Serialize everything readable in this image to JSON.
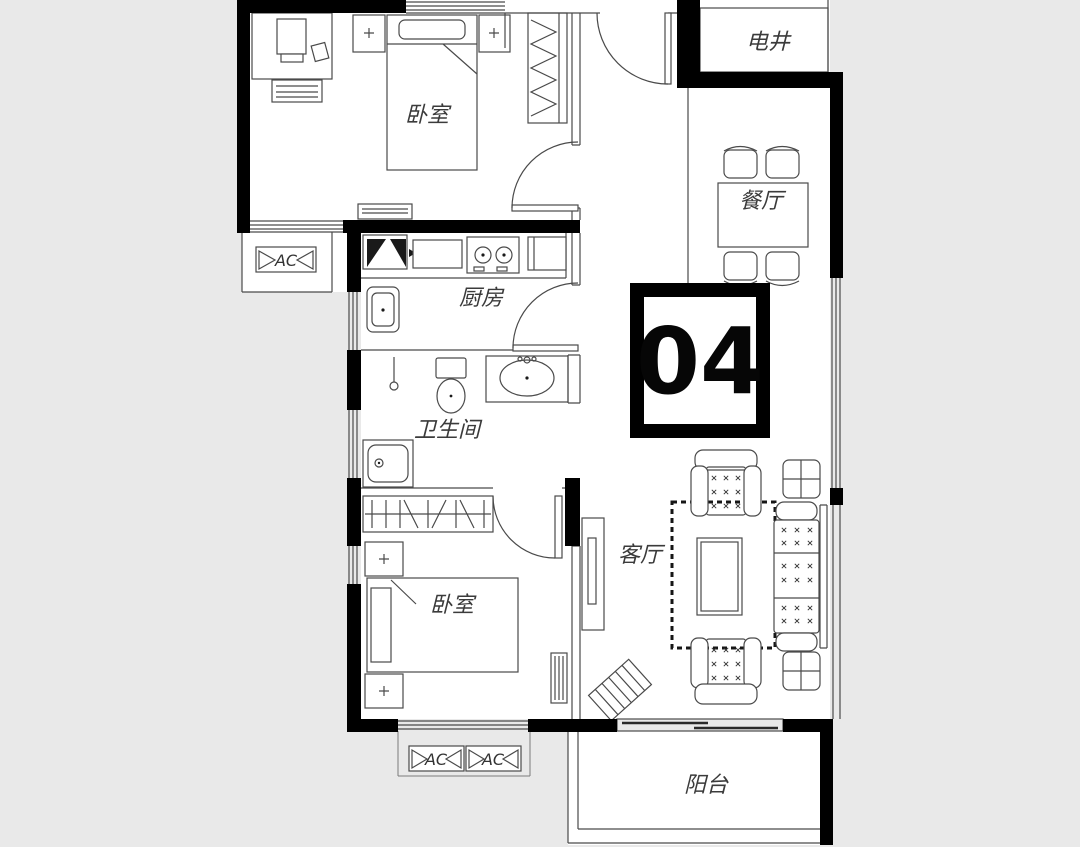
{
  "floor_plan": {
    "unit_badge": "04",
    "rooms": {
      "bedroom_top": "卧室",
      "kitchen": "厨房",
      "bathroom": "卫生间",
      "bedroom_bottom": "卧室",
      "living_room": "客厅",
      "dining_room": "餐厅",
      "utility_shaft": "电井",
      "balcony": "阳台"
    },
    "ac_labels": [
      "AC",
      "AC",
      "AC"
    ],
    "colors": {
      "background": "#e9e9e9",
      "floor": "#ffffff",
      "wall": "#000000",
      "line": "#4a4a4a"
    }
  }
}
